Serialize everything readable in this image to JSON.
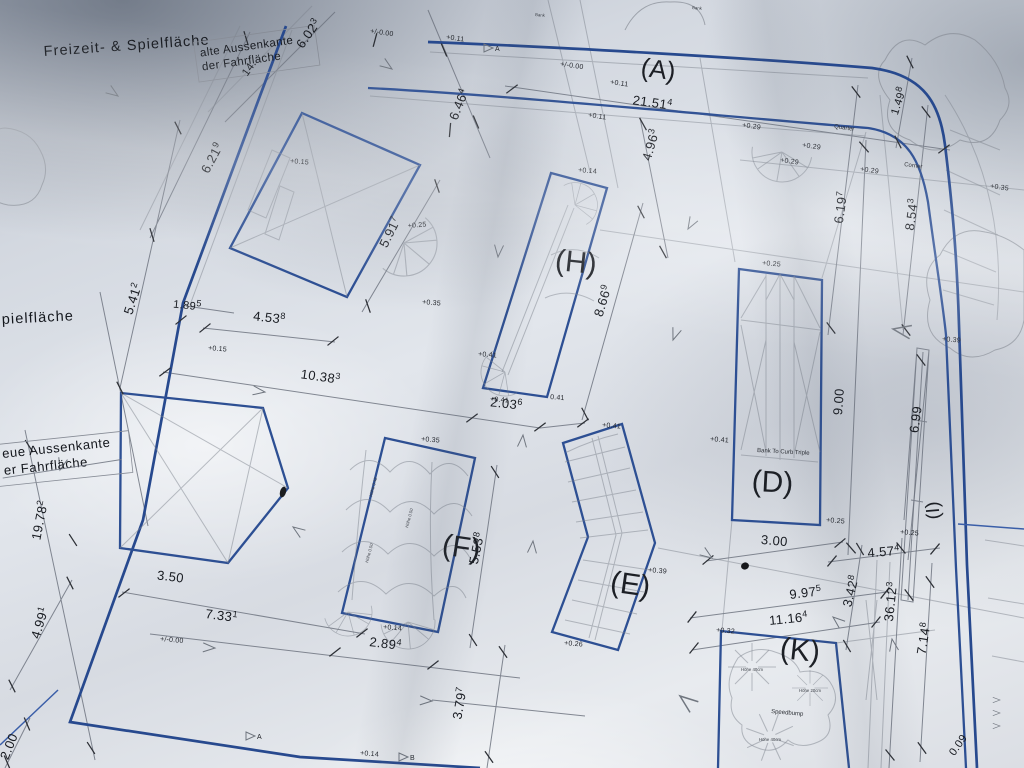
{
  "plan": {
    "area_labels": {
      "a": "(A)",
      "d": "(D)",
      "e": "(E)",
      "f": "(F)",
      "h": "(H)",
      "i": "(I)",
      "k": "(K)"
    },
    "texts": {
      "freizeit": "Freizeit- & Spielfläche",
      "alte_line1": "alte Aussenkante",
      "alte_line2": "der Fahrfläche",
      "spielflaeche_partial": "pielfläche",
      "neue_line1": "eue Aussenkante",
      "neue_line2": "er Fahrfläche",
      "bank_to_curb": "Bank To Curb Triple",
      "speedbump": "Speedbump",
      "quarter": "Quarter",
      "corner": "Corner",
      "bank": "Bank",
      "hoehe40": "Höhe 40cm",
      "hoehe20": "Höhe 20cm",
      "hoehe050": "Höhe 0.50",
      "hoehe042": "Höhe 0.42",
      "section_a": "A",
      "section_b": "B"
    },
    "dimensions": {
      "d6023": {
        "m": "6.02",
        "s": "3"
      },
      "d14": {
        "m": "14.",
        "s": ""
      },
      "d6219": {
        "m": "6.21",
        "s": "9"
      },
      "d6464": {
        "m": "6.46",
        "s": "4"
      },
      "d21514": {
        "m": "21.51",
        "s": "4"
      },
      "d4963": {
        "m": "4.96",
        "s": "3"
      },
      "d5917": {
        "m": "5.91",
        "s": "7"
      },
      "d8669": {
        "m": "8.66",
        "s": "9"
      },
      "d1498": {
        "m": "1.49",
        "s": "8"
      },
      "d6197": {
        "m": "6.19",
        "s": "7"
      },
      "d8543": {
        "m": "8.54",
        "s": "3"
      },
      "d5412": {
        "m": "5.41",
        "s": "2"
      },
      "d1895": {
        "m": "1.89",
        "s": "5"
      },
      "d4538": {
        "m": "4.53",
        "s": "8"
      },
      "d10383": {
        "m": "10.38",
        "s": "3"
      },
      "d2036": {
        "m": "2.03",
        "s": "6"
      },
      "d900": {
        "m": "9.00",
        "s": ""
      },
      "d699": {
        "m": "6.99",
        "s": ""
      },
      "d19782": {
        "m": "19.78",
        "s": "2"
      },
      "d4991": {
        "m": "4.99",
        "s": "1"
      },
      "d200": {
        "m": "2.00",
        "s": ""
      },
      "d350": {
        "m": "3.50",
        "s": ""
      },
      "d7331": {
        "m": "7.33",
        "s": "1"
      },
      "d2894": {
        "m": "2.89",
        "s": "4"
      },
      "d3797": {
        "m": "3.79",
        "s": "7"
      },
      "d5538": {
        "m": "5.53",
        "s": "8"
      },
      "d300": {
        "m": "3.00",
        "s": ""
      },
      "d4574": {
        "m": "4.57",
        "s": "4"
      },
      "d9975": {
        "m": "9.97",
        "s": "5"
      },
      "d3428": {
        "m": "3.42",
        "s": "8"
      },
      "d36123": {
        "m": "36.12",
        "s": "3"
      },
      "d11164": {
        "m": "11.16",
        "s": "4"
      },
      "d7148": {
        "m": "7.14",
        "s": "8"
      },
      "d009": {
        "m": "0.09",
        "s": ""
      }
    },
    "elevations": {
      "e000": "+/-0.00",
      "e011": "+0.11",
      "e014": "+0.14",
      "e015": "+0.15",
      "e025": "+0.25",
      "e026": "+0.26",
      "e029": "+0.29",
      "e032": "+0.32",
      "e035": "+0.35",
      "e039": "+0.39",
      "e041": "+0.41",
      "e041b": "0.41"
    },
    "colors": {
      "ink_blue": "#2d4f93",
      "ink_gray": "#6e7480",
      "ink_dark": "#181b21",
      "paper": "#dde1e7"
    }
  }
}
